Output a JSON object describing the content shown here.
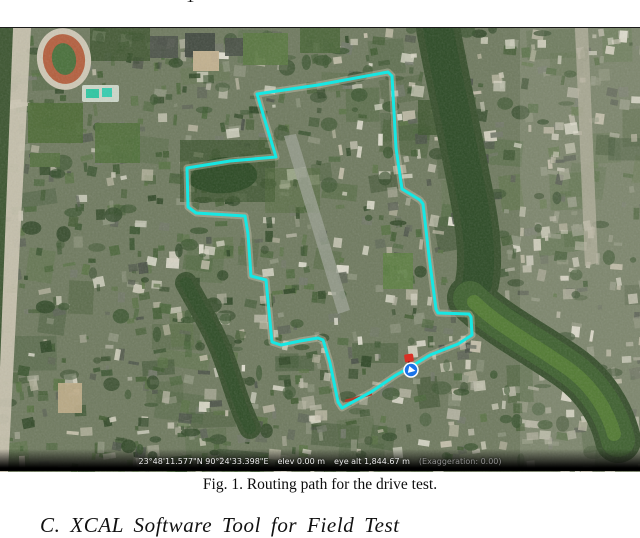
{
  "page": {
    "top_fragment": "1",
    "caption": "Fig. 1. Routing path for the drive test.",
    "section_heading": "C. XCAL Software Tool for Field Test"
  },
  "map": {
    "status_bar": {
      "coordinates": "23°48'11.577\"N 90°24'33.398\"E",
      "elevation": "elev 0.00 m",
      "eye_alt": "eye alt 1,844.67 m",
      "exaggeration": "(Exaggeration: 0.00)"
    },
    "route": {
      "color": "#16e7e3",
      "road_underlay_color": "#d2cdba",
      "points": [
        [
          257,
          66
        ],
        [
          318,
          57
        ],
        [
          388,
          44
        ],
        [
          392,
          48
        ],
        [
          396,
          120
        ],
        [
          402,
          161
        ],
        [
          420,
          172
        ],
        [
          423,
          176
        ],
        [
          429,
          228
        ],
        [
          436,
          281
        ],
        [
          438,
          285
        ],
        [
          469,
          286
        ],
        [
          471,
          289
        ],
        [
          472,
          307
        ],
        [
          458,
          316
        ],
        [
          430,
          327
        ],
        [
          412,
          338
        ],
        [
          396,
          347
        ],
        [
          371,
          364
        ],
        [
          349,
          376
        ],
        [
          342,
          380
        ],
        [
          338,
          374
        ],
        [
          330,
          335
        ],
        [
          323,
          312
        ],
        [
          318,
          310
        ],
        [
          300,
          313
        ],
        [
          281,
          317
        ],
        [
          272,
          314
        ],
        [
          268,
          273
        ],
        [
          266,
          252
        ],
        [
          251,
          248
        ],
        [
          248,
          206
        ],
        [
          245,
          188
        ],
        [
          196,
          185
        ],
        [
          188,
          179
        ],
        [
          187,
          140
        ],
        [
          230,
          133
        ],
        [
          276,
          129
        ],
        [
          266,
          96
        ],
        [
          257,
          66
        ]
      ],
      "red_segment": [
        [
          345,
          373
        ],
        [
          372,
          366
        ]
      ]
    },
    "markers": {
      "placemark_pin": {
        "x": 409,
        "y": 330,
        "color": "#d93025"
      },
      "navigation": {
        "x": 411,
        "y": 342,
        "color": "#1a73e8"
      }
    },
    "palette": {
      "greens": [
        "#2f4726",
        "#3b5530",
        "#4a663a",
        "#587243",
        "#425c33"
      ],
      "lights": [
        "#8f967f",
        "#b7b6a4",
        "#d6d3c2",
        "#e7e4d6",
        "#c8c2ae"
      ],
      "roofs": [
        "#4a5147",
        "#5d6456",
        "#73796a"
      ],
      "water": "#2d4b26",
      "water_light": "#527a33",
      "tree_bank": "#374f2c"
    }
  }
}
